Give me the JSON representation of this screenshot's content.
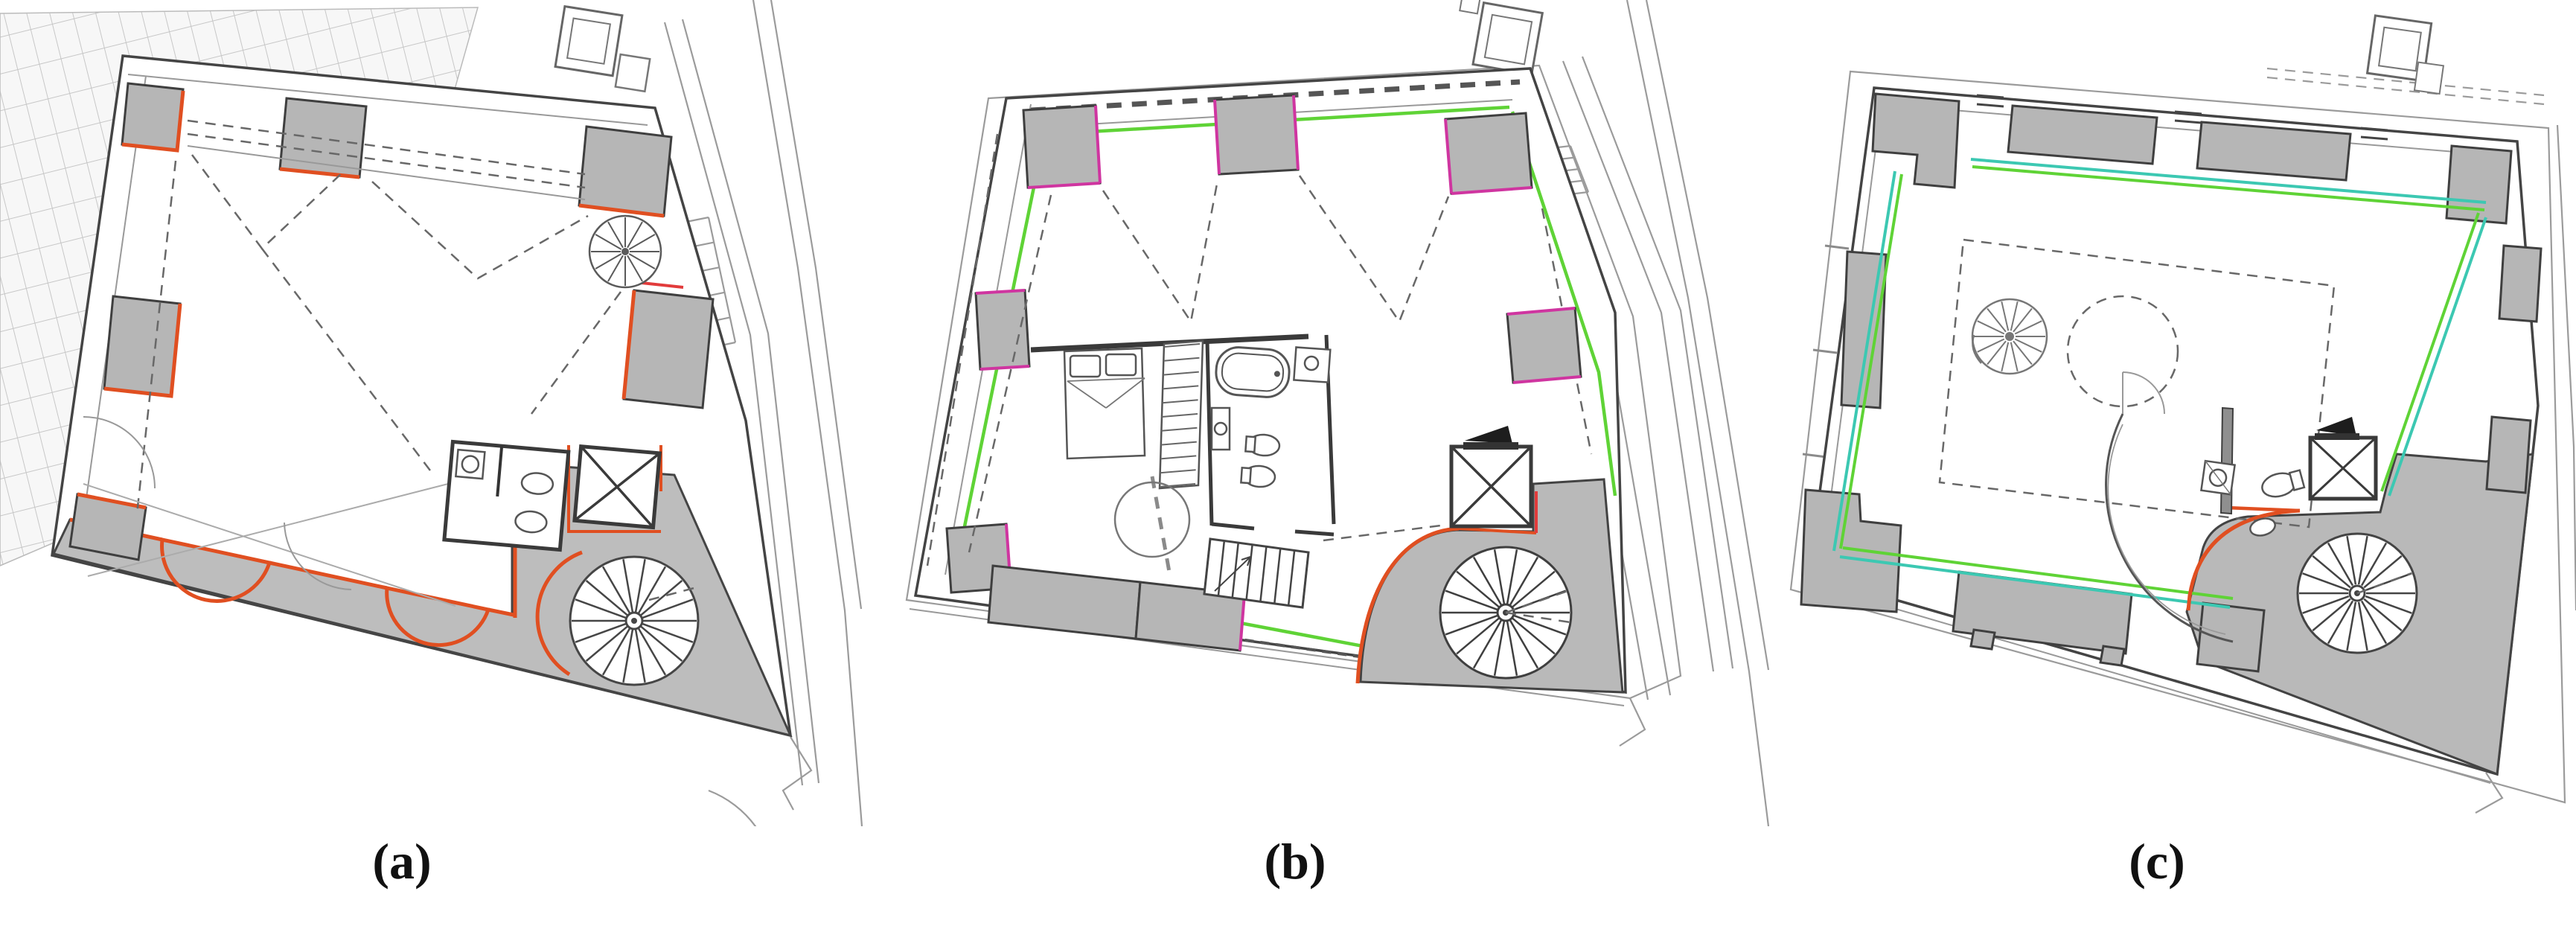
{
  "figure": {
    "type": "architectural-floor-plans",
    "panels": [
      {
        "id": "a",
        "label": "(a)"
      },
      {
        "id": "b",
        "label": "(b)"
      },
      {
        "id": "c",
        "label": "(c)"
      }
    ],
    "colors": {
      "orange": "#e04f21",
      "green": "#5fd336",
      "magenta": "#cf35a0",
      "cyan": "#3cc8b2",
      "red": "#e23b3b"
    }
  }
}
